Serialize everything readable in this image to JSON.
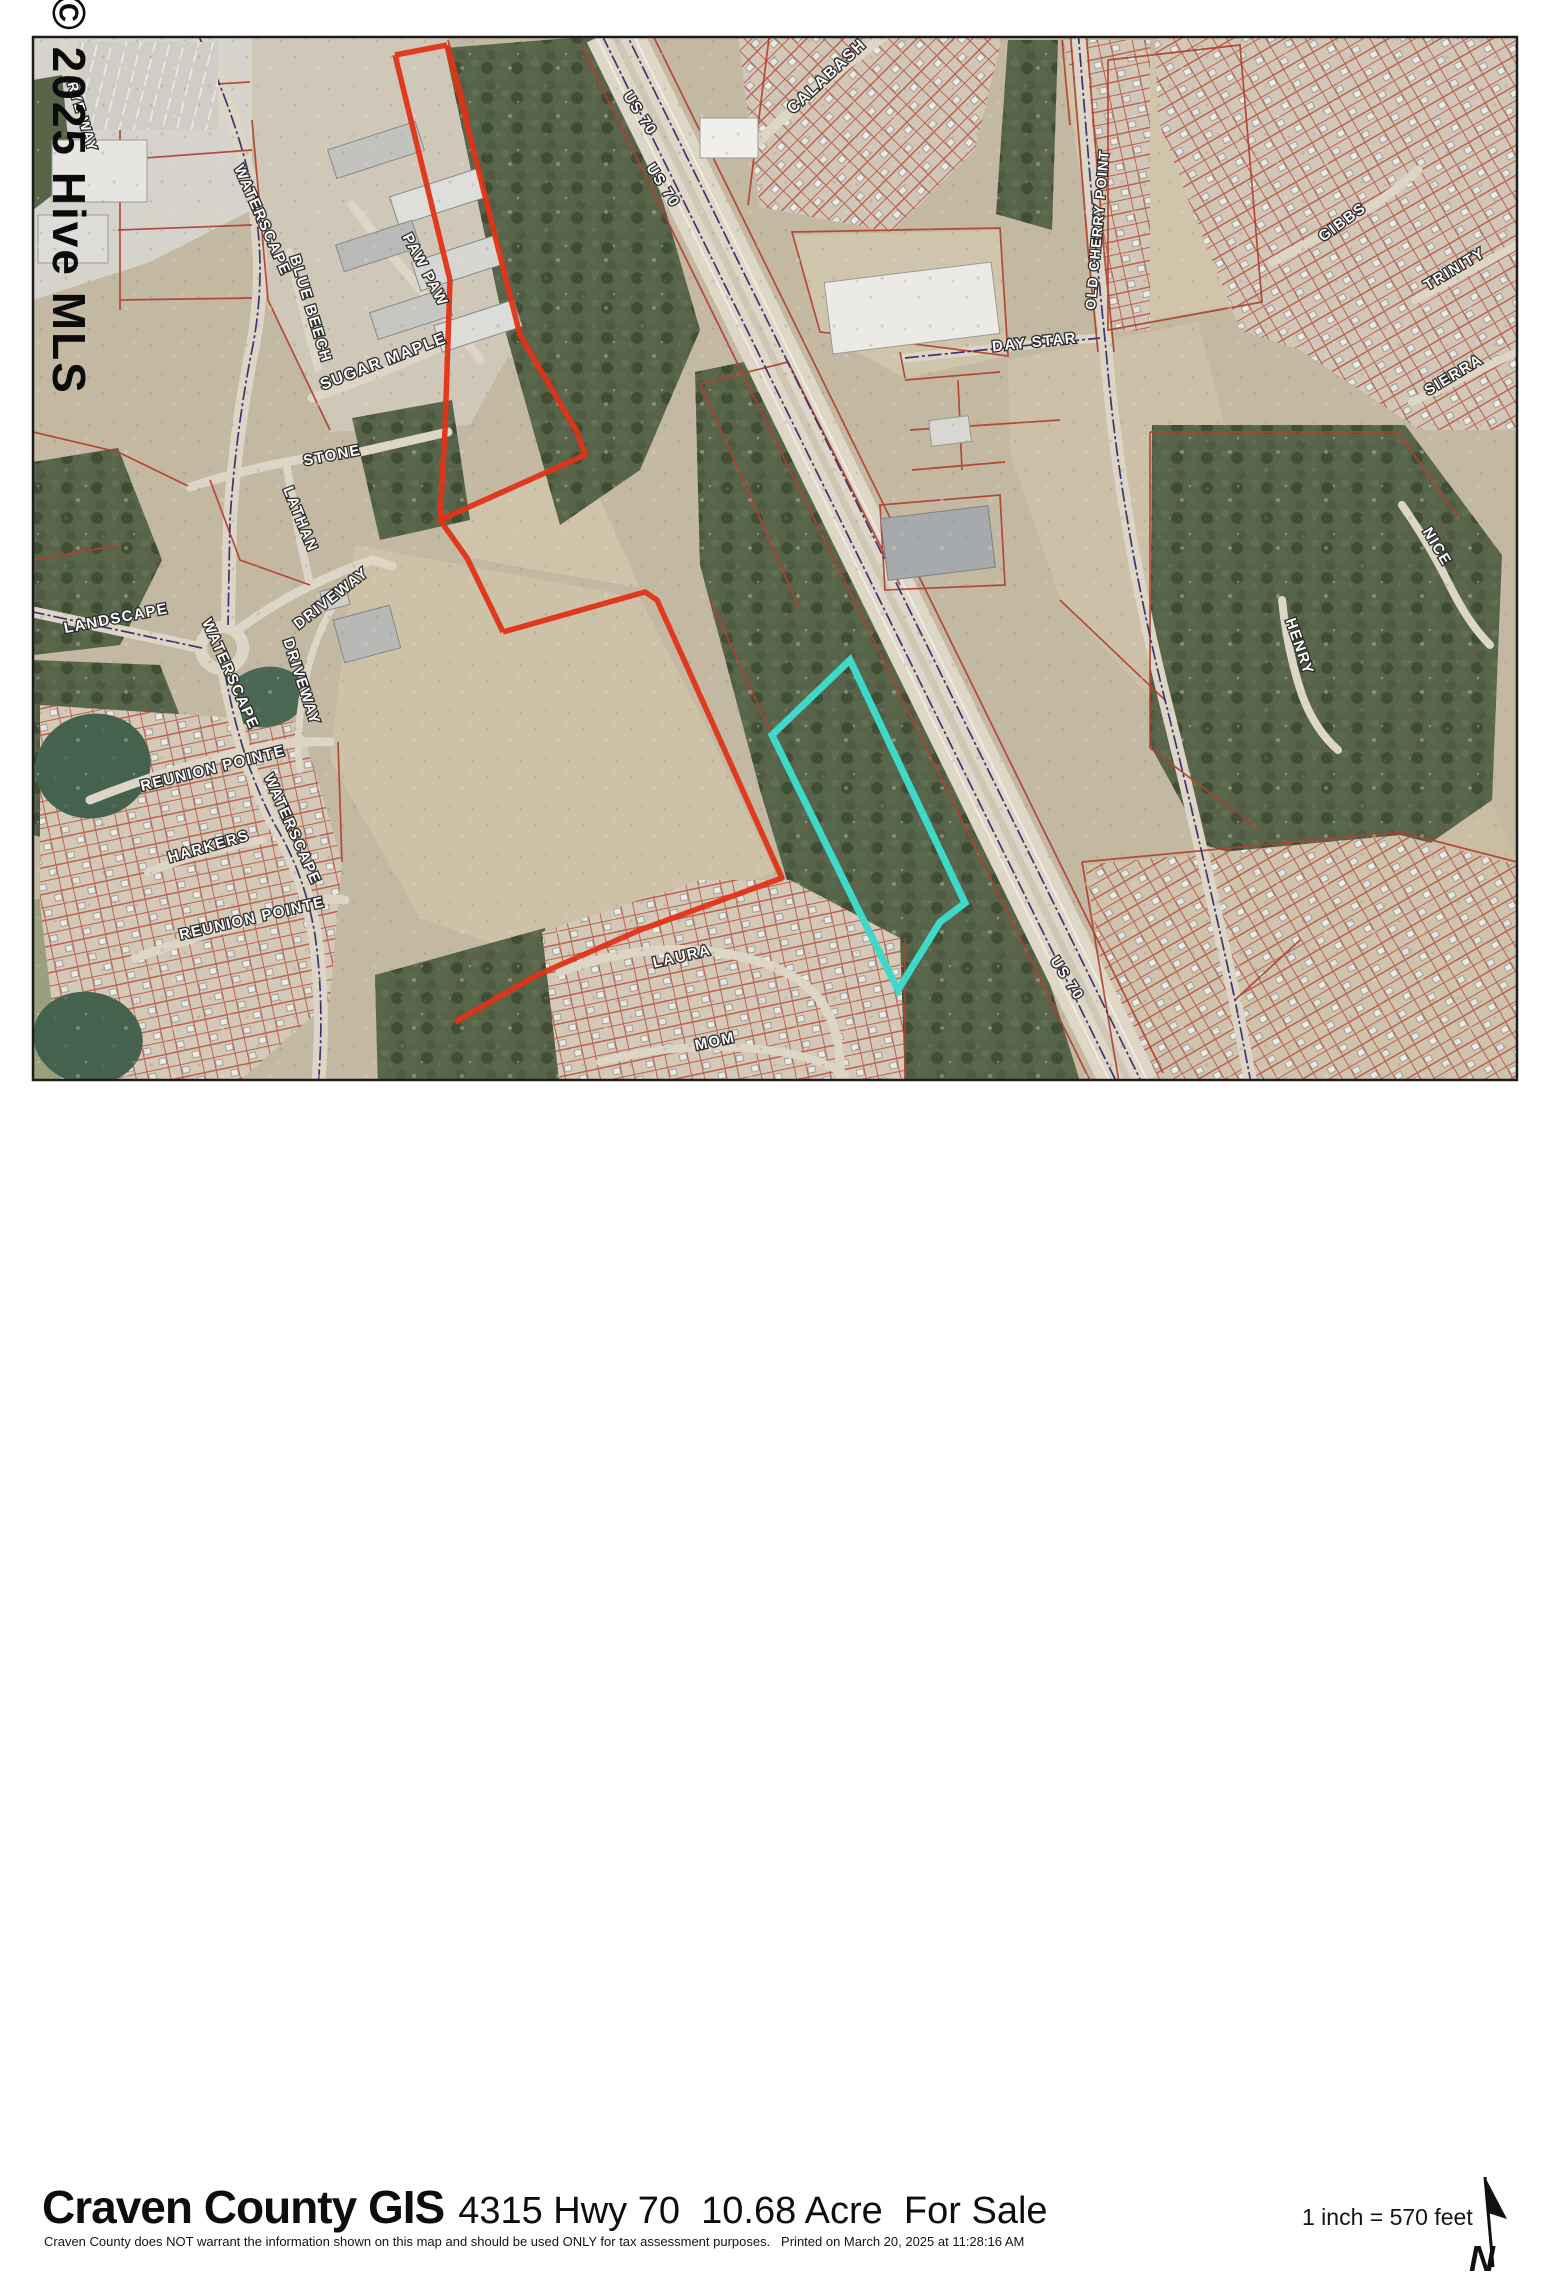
{
  "watermark_text": "© 2025 Hive MLS",
  "map": {
    "highlight_parcel_color": "#3ed9cb",
    "parcel_line_color": "#b1402f",
    "boundary_color": "#e23317",
    "labels": [
      {
        "text": "RYE WAY",
        "x": 78,
        "y": 118,
        "rot": 73,
        "size": 14
      },
      {
        "text": "WATERSCAPE",
        "x": 258,
        "y": 222,
        "rot": 66,
        "size": 15
      },
      {
        "text": "PAW PAW",
        "x": 421,
        "y": 272,
        "rot": 62,
        "size": 15
      },
      {
        "text": "BLUE BEECH",
        "x": 306,
        "y": 310,
        "rot": 73,
        "size": 15
      },
      {
        "text": "SUGAR MAPLE",
        "x": 385,
        "y": 366,
        "rot": -21,
        "size": 16
      },
      {
        "text": "STONE",
        "x": 333,
        "y": 460,
        "rot": -11,
        "size": 15
      },
      {
        "text": "LATHAN",
        "x": 296,
        "y": 521,
        "rot": 68,
        "size": 15
      },
      {
        "text": "US 70",
        "x": 636,
        "y": 116,
        "rot": 57,
        "size": 15
      },
      {
        "text": "US 70",
        "x": 659,
        "y": 188,
        "rot": 57,
        "size": 15
      },
      {
        "text": "CALABASH",
        "x": 830,
        "y": 80,
        "rot": -43,
        "size": 16
      },
      {
        "text": "OLD CHERRY POINT",
        "x": 1102,
        "y": 230,
        "rot": -85,
        "size": 14
      },
      {
        "text": "DAY STAR",
        "x": 1035,
        "y": 347,
        "rot": -6,
        "size": 15
      },
      {
        "text": "GIBBS",
        "x": 1345,
        "y": 226,
        "rot": -36,
        "size": 15
      },
      {
        "text": "TRINITY",
        "x": 1457,
        "y": 273,
        "rot": -31,
        "size": 15
      },
      {
        "text": "SIERRA",
        "x": 1456,
        "y": 379,
        "rot": -31,
        "size": 15
      },
      {
        "text": "NICE",
        "x": 1433,
        "y": 549,
        "rot": 59,
        "size": 15
      },
      {
        "text": "HENRY",
        "x": 1295,
        "y": 648,
        "rot": 71,
        "size": 15
      },
      {
        "text": "LANDSCAPE",
        "x": 117,
        "y": 623,
        "rot": -11,
        "size": 15
      },
      {
        "text": "DRIVEWAY",
        "x": 334,
        "y": 602,
        "rot": -38,
        "size": 15
      },
      {
        "text": "DRIVEWAY",
        "x": 297,
        "y": 683,
        "rot": 72,
        "size": 15
      },
      {
        "text": "WATERSCAPE",
        "x": 226,
        "y": 676,
        "rot": 66,
        "size": 15
      },
      {
        "text": "REUNION POINTE",
        "x": 214,
        "y": 773,
        "rot": -14,
        "size": 15
      },
      {
        "text": "HARKERS",
        "x": 210,
        "y": 851,
        "rot": -16,
        "size": 15
      },
      {
        "text": "WATERSCAPE",
        "x": 288,
        "y": 831,
        "rot": 66,
        "size": 15
      },
      {
        "text": "REUNION POINTE",
        "x": 253,
        "y": 923,
        "rot": -13,
        "size": 15
      },
      {
        "text": "LAURA",
        "x": 683,
        "y": 961,
        "rot": -13,
        "size": 15
      },
      {
        "text": "MOM",
        "x": 716,
        "y": 1046,
        "rot": -12,
        "size": 15
      },
      {
        "text": "US 70",
        "x": 1063,
        "y": 981,
        "rot": 57,
        "size": 15
      }
    ]
  },
  "footer": {
    "title": "Craven County GIS",
    "subtitle": "4315 Hwy 70  10.68 Acre  For Sale",
    "disclaimer": "Craven County does NOT warrant the information shown on this map and should be used ONLY for tax assessment purposes.   Printed on March 20, 2025 at 11:28:16 AM",
    "scale_text": "1 inch = 570 feet",
    "north_label": "N"
  }
}
